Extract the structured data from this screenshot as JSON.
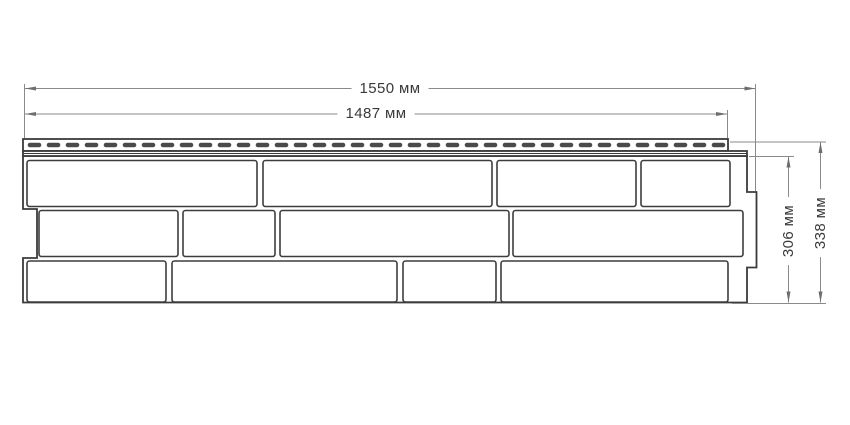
{
  "diagram": {
    "kind": "technical-drawing",
    "subject": "facade siding panel with brick pattern and perforated nailing strip",
    "dimensions": {
      "total_width": {
        "label": "1550 мм",
        "value": 1550,
        "unit": "мм"
      },
      "strip_width": {
        "label": "1487 мм",
        "value": 1487,
        "unit": "мм"
      },
      "body_height": {
        "label": "306 мм",
        "value": 306,
        "unit": "мм"
      },
      "total_height": {
        "label": "338 мм",
        "value": 338,
        "unit": "мм"
      }
    },
    "panel": {
      "rows": 3,
      "bricks_per_row": 4,
      "perforated_nail_strip": true,
      "bricks": [
        {
          "row": 1,
          "x": 27,
          "y": 160.5,
          "w": 230,
          "h": 46
        },
        {
          "row": 1,
          "x": 263,
          "y": 160.5,
          "w": 229,
          "h": 46
        },
        {
          "row": 1,
          "x": 497,
          "y": 160.5,
          "w": 139,
          "h": 46
        },
        {
          "row": 1,
          "x": 641,
          "y": 160.5,
          "w": 89,
          "h": 46
        },
        {
          "row": 2,
          "x": 39,
          "y": 210.5,
          "w": 139,
          "h": 46
        },
        {
          "row": 2,
          "x": 183,
          "y": 210.5,
          "w": 92,
          "h": 46
        },
        {
          "row": 2,
          "x": 280,
          "y": 210.5,
          "w": 229,
          "h": 46
        },
        {
          "row": 2,
          "x": 513,
          "y": 210.5,
          "w": 230,
          "h": 46
        },
        {
          "row": 3,
          "x": 27,
          "y": 261,
          "w": 139,
          "h": 41
        },
        {
          "row": 3,
          "x": 172,
          "y": 261,
          "w": 225,
          "h": 41
        },
        {
          "row": 3,
          "x": 403,
          "y": 261,
          "w": 93,
          "h": 41
        },
        {
          "row": 3,
          "x": 501,
          "y": 261,
          "w": 227,
          "h": 41
        }
      ]
    },
    "colors": {
      "outline": "#3b3b3b",
      "brick_border": "#3d3d3d",
      "perforation": "#4a4a4a",
      "dimension_line": "#8a8a8a",
      "arrow": "#6e6e6e",
      "text": "#3a3a3a",
      "background": "#ffffff"
    }
  }
}
